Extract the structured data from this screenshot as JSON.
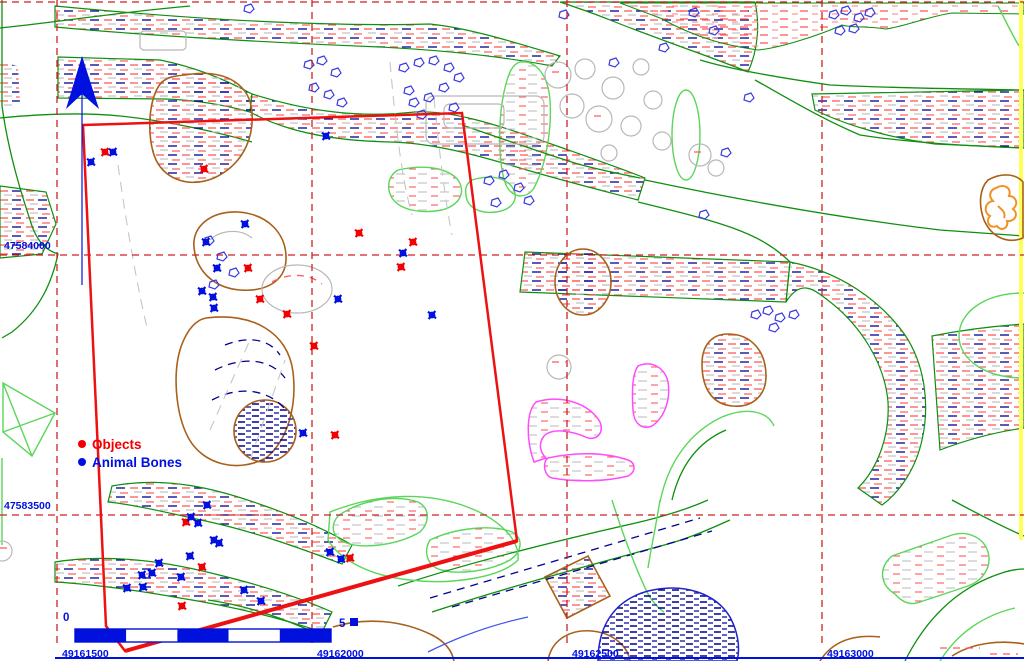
{
  "legend": {
    "items": [
      {
        "label": "Objects",
        "color": "#f20000"
      },
      {
        "label": "Animal Bones",
        "color": "#0010e0"
      }
    ]
  },
  "grid": {
    "line_color": "#cc2222",
    "label_color": "#0010e0",
    "top_edge_y": 2,
    "vertical": [
      {
        "label": "49161500",
        "x": 57
      },
      {
        "label": "49162000",
        "x": 312
      },
      {
        "label": "49162500",
        "x": 567
      },
      {
        "label": "49163000",
        "x": 822
      }
    ],
    "horizontal": [
      {
        "label": "47584000",
        "y": 255
      },
      {
        "label": "47583500",
        "y": 515
      }
    ]
  },
  "scale_bar": {
    "zero_label": "0",
    "end_label": "5",
    "bar_color": "#0010dd",
    "x": 75,
    "y": 629,
    "width": 256,
    "height": 13,
    "segments": 5
  },
  "north_arrow": {
    "color": "#0010e0"
  },
  "survey_area": {
    "color": "#ee1111",
    "points": [
      [
        83,
        125
      ],
      [
        462,
        113
      ],
      [
        517,
        541
      ],
      [
        125,
        651
      ],
      [
        106,
        626
      ]
    ]
  },
  "points": {
    "objects": {
      "color": "#f20000",
      "coords": [
        [
          105,
          152
        ],
        [
          204,
          169
        ],
        [
          359,
          233
        ],
        [
          413,
          242
        ],
        [
          401,
          267
        ],
        [
          248,
          268
        ],
        [
          260,
          299
        ],
        [
          287,
          314
        ],
        [
          314,
          346
        ],
        [
          335,
          435
        ],
        [
          186,
          522
        ],
        [
          202,
          567
        ],
        [
          182,
          606
        ],
        [
          350,
          558
        ]
      ]
    },
    "animal_bones": {
      "color": "#0010e0",
      "coords": [
        [
          113,
          152
        ],
        [
          91,
          162
        ],
        [
          326,
          136
        ],
        [
          245,
          224
        ],
        [
          206,
          242
        ],
        [
          217,
          268
        ],
        [
          202,
          291
        ],
        [
          213,
          297
        ],
        [
          214,
          308
        ],
        [
          403,
          253
        ],
        [
          338,
          299
        ],
        [
          432,
          315
        ],
        [
          303,
          433
        ],
        [
          207,
          505
        ],
        [
          191,
          517
        ],
        [
          198,
          523
        ],
        [
          214,
          540
        ],
        [
          219,
          543
        ],
        [
          190,
          556
        ],
        [
          159,
          563
        ],
        [
          152,
          573
        ],
        [
          142,
          575
        ],
        [
          181,
          577
        ],
        [
          127,
          588
        ],
        [
          143,
          587
        ],
        [
          244,
          590
        ],
        [
          261,
          601
        ],
        [
          330,
          552
        ],
        [
          341,
          559
        ]
      ]
    }
  },
  "map_colors": {
    "boundary_green": "#0f8f0f",
    "light_green": "#5ad65a",
    "brown": "#a8601a",
    "gray": "#b8b8b8",
    "hatch_red": "#ff5a5a",
    "hatch_blue": "#000090",
    "magenta": "#ff4cff",
    "orange": "#f29022",
    "yellow": "#ffff55",
    "bottom_rule_color": "#0010e0"
  }
}
